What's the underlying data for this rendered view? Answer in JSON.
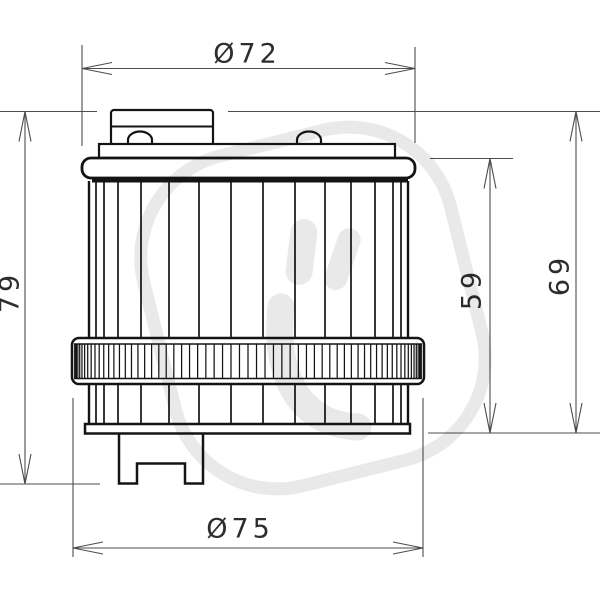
{
  "figure": {
    "type": "engineering-drawing",
    "subject": "oil filter side elevation with dimension annotations",
    "dimensions": {
      "top_diameter": "Ø72",
      "bottom_diameter": "Ø75",
      "total_height": "79",
      "body_height": "59",
      "cap_to_base_height": "69"
    },
    "colors": {
      "background": "#ffffff",
      "ink": "#141414",
      "dimension": "#4d4d4d",
      "watermark": "#e9e9e9"
    }
  }
}
